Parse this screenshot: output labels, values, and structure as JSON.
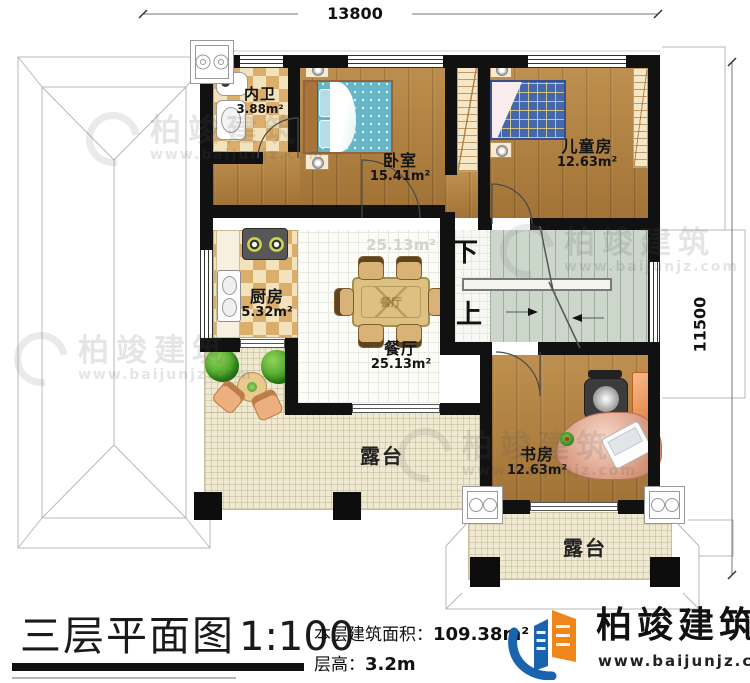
{
  "title_block": {
    "title": "三层平面图",
    "scale": "1:100",
    "area_label": "本层建筑面积：",
    "area_value": "109.38m²",
    "floor_height_label": "层高：",
    "floor_height_value": "3.2m"
  },
  "brand": {
    "name": "柏竣建筑",
    "website": "www.baijunjz.com"
  },
  "watermark": {
    "name": "柏竣建筑",
    "website": "www.baijunjz.com"
  },
  "dimensions": {
    "top_width": "13800",
    "right_height": "11500"
  },
  "stairs": {
    "down_label": "下",
    "up_label": "上"
  },
  "rooms": [
    {
      "id": "bathroom",
      "label": "内卫",
      "area": "3.88m²"
    },
    {
      "id": "bedroom",
      "label": "卧室",
      "area": "15.41m²"
    },
    {
      "id": "kids-room",
      "label": "儿童房",
      "area": "12.63m²"
    },
    {
      "id": "kitchen",
      "label": "厨房",
      "area": "5.32m²"
    },
    {
      "id": "dining-room",
      "label": "餐厅",
      "area": "25.13m²"
    },
    {
      "id": "study",
      "label": "书房",
      "area": "12.63m²"
    },
    {
      "id": "terrace-left",
      "label": "露台",
      "area": ""
    },
    {
      "id": "terrace-bottom",
      "label": "露台",
      "area": ""
    }
  ],
  "colors": {
    "wall": "#111111",
    "wood_floor": "#b2813f",
    "checker_tan": "#dcae6c",
    "checker_cream": "#f3e3bc",
    "tile_floor": "#fcfcf9",
    "terrace_floor": "#efe9d2",
    "stair_floor": "#ccd6cb",
    "bed_teal": "#66b6c8",
    "kids_bed_blue": "#4568ad",
    "desk_salmon": "#d89079",
    "plant_green": "#2e8b1f",
    "logo_blue": "#1a63ae",
    "logo_orange": "#f08519"
  }
}
